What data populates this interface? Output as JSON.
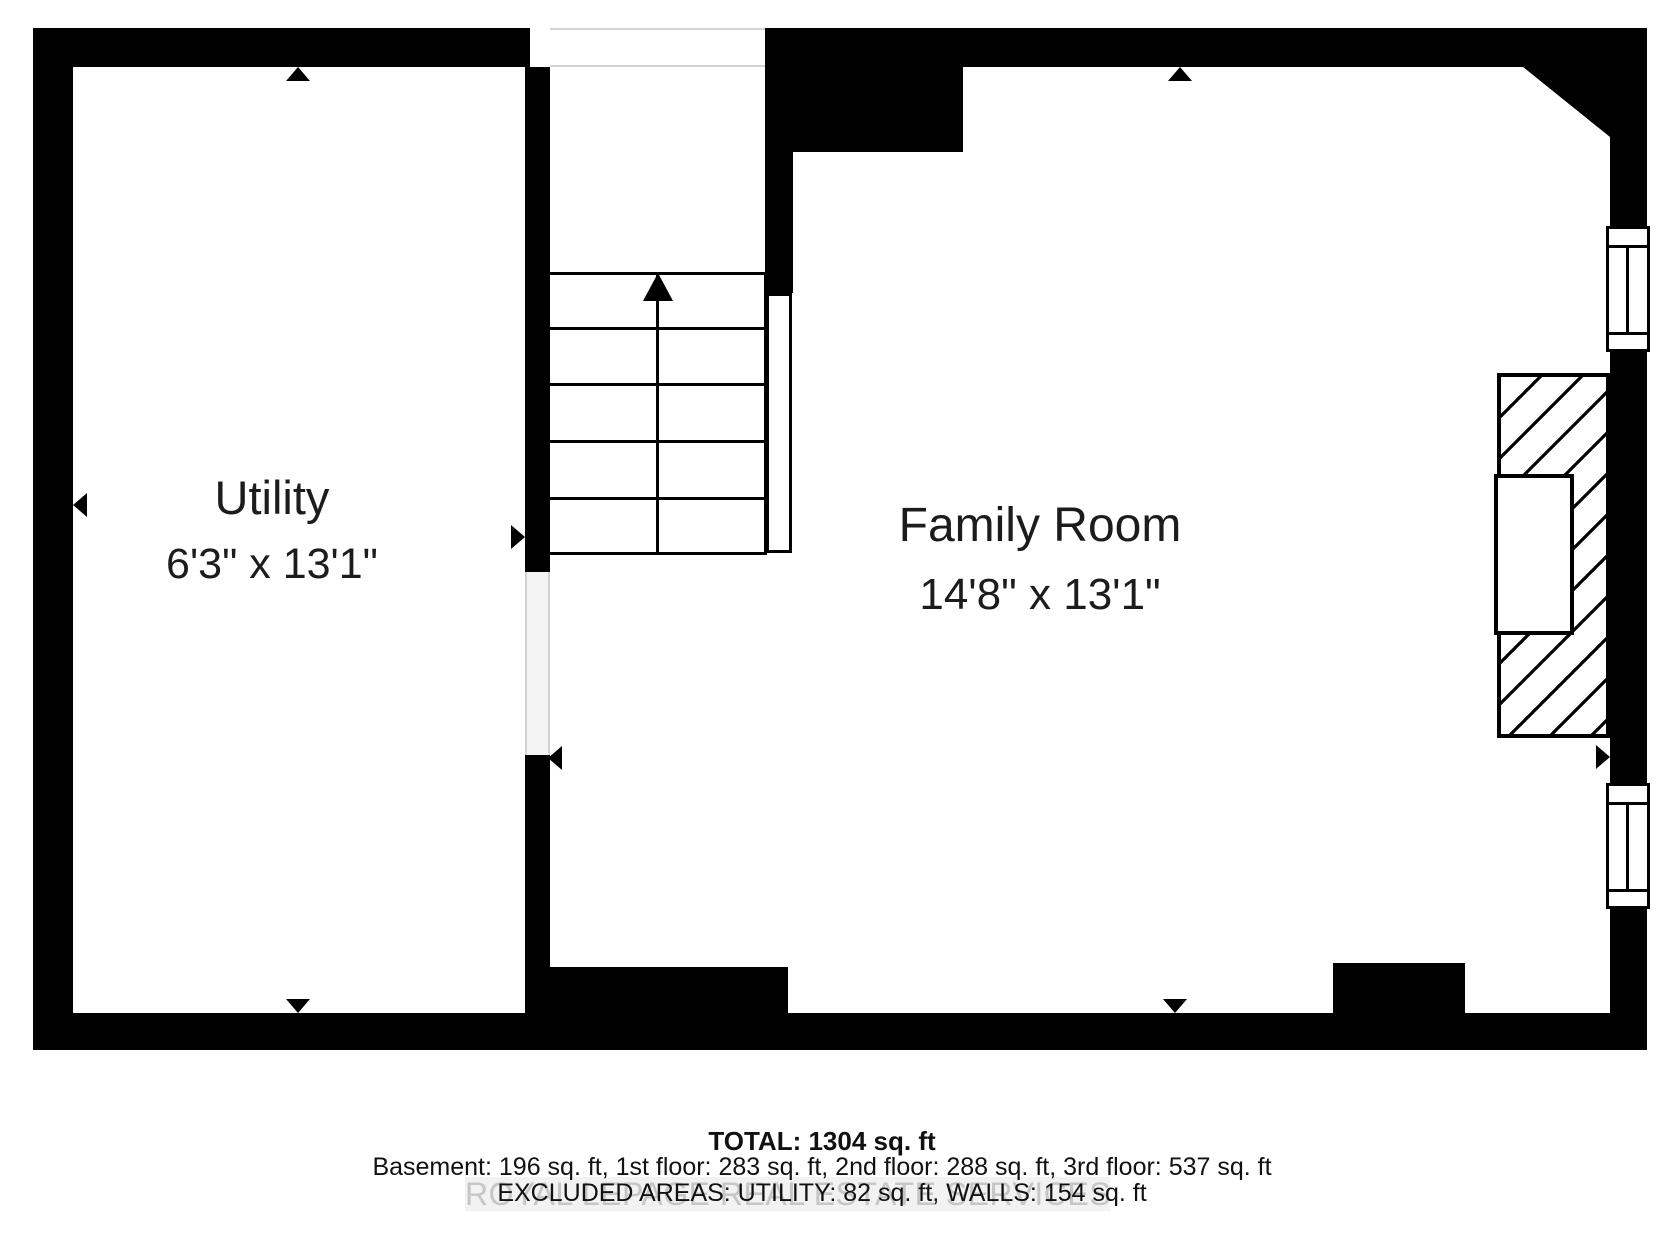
{
  "rooms": [
    {
      "name": "Utility",
      "dimensions": "6'3\" x 13'1\""
    },
    {
      "name": "Family Room",
      "dimensions": "14'8\" x 13'1\""
    }
  ],
  "summary": {
    "total": "TOTAL: 1304 sq. ft",
    "floors": "Basement: 196 sq. ft, 1st floor: 283 sq. ft, 2nd floor: 288 sq. ft, 3rd floor: 537 sq. ft",
    "excluded": "EXCLUDED AREAS: UTILITY: 82 sq. ft, WALLS: 154 sq. ft"
  },
  "watermark": {
    "text": "ROYAL LEPAGE REAL ESTATE SERVICES Brokerage"
  },
  "icons": {
    "stairs-up-arrow": "triangle-up",
    "dimension-marker": "triangle"
  },
  "colors": {
    "wall": "#000000",
    "text": "#1c1c1c",
    "opening_line": "#d2d2d2",
    "watermark_text": "#c6c6c6"
  }
}
